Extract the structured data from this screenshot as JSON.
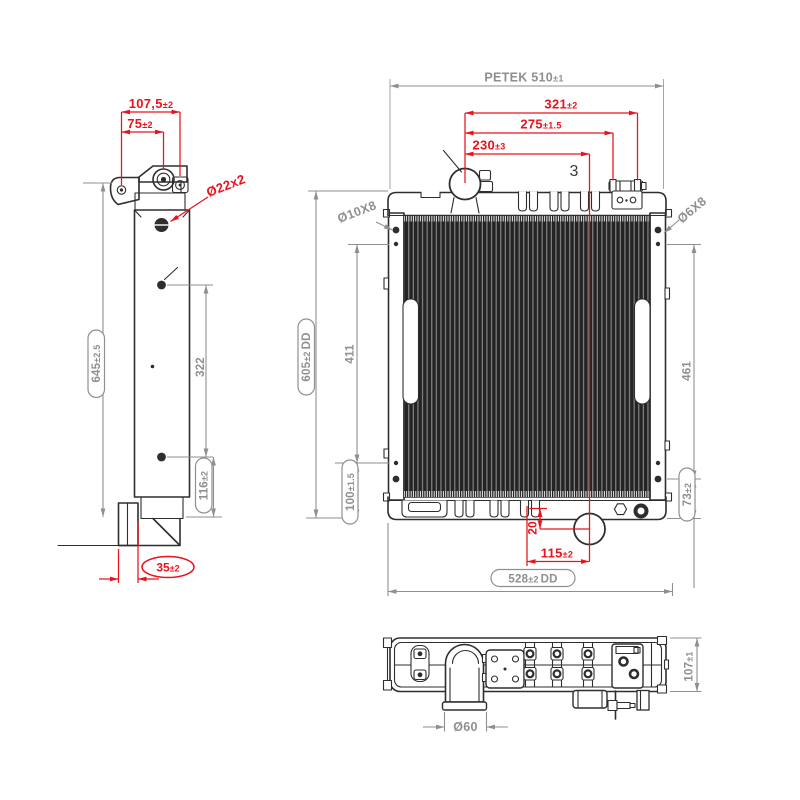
{
  "colors": {
    "line": "#2e2e2e",
    "dim_gray": "#8f8f8f",
    "dim_red": "#e8131d",
    "background": "#ffffff"
  },
  "side_view": {
    "dim_width_top": {
      "v": "107,5",
      "t": "±2"
    },
    "dim_width_inner": {
      "v": "75",
      "t": "±2"
    },
    "dim_plug": {
      "v": "Ø22x2"
    },
    "dim_height": {
      "v": "645",
      "t": "±2.5"
    },
    "dim_hole_span": {
      "v": "322"
    },
    "dim_hole_bottom": {
      "v": "116",
      "t": "±2"
    },
    "dim_foot_offset": {
      "v": "35",
      "t": "±2"
    }
  },
  "front_view": {
    "dim_overall_width": {
      "v": "PETEK 510",
      "t": "±1"
    },
    "dim_bracket_outer": {
      "v": "321",
      "t": "±2"
    },
    "dim_bracket_inner": {
      "v": "275",
      "t": "±1.5"
    },
    "dim_outlet_offset": {
      "v": "230",
      "t": "±3"
    },
    "label_qty": {
      "v": "3"
    },
    "dim_hole_left": {
      "v": "Ø10X8"
    },
    "dim_hole_right": {
      "v": "Ø6X8"
    },
    "dim_overall_height": {
      "v": "605",
      "t": "±2",
      "s": "DD"
    },
    "dim_hole_span_left": {
      "v": "411"
    },
    "dim_hole_span_right": {
      "v": "461"
    },
    "dim_bottom_left": {
      "v": "100",
      "t": "±1.5"
    },
    "dim_bottom_right": {
      "v": "73",
      "t": "±2"
    },
    "dim_outlet_drop": {
      "v": "20"
    },
    "dim_outlet_x": {
      "v": "115",
      "t": "±2"
    },
    "dim_bottom_width": {
      "v": "528",
      "t": "±2",
      "s": "DD"
    }
  },
  "bottom_view": {
    "dim_pipe": {
      "v": "Ø60"
    },
    "dim_depth": {
      "v": "107",
      "t": "±1"
    }
  }
}
